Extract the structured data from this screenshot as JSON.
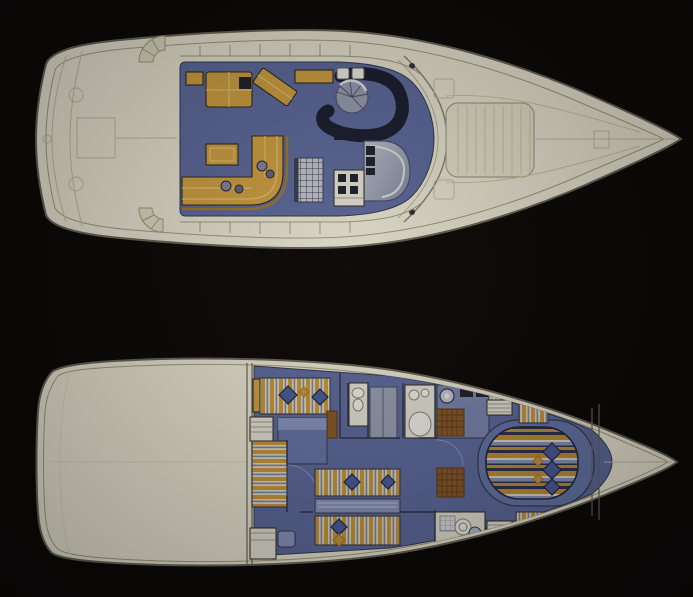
{
  "page": {
    "title": "Motor yacht general-arrangement drawing: two deck plans on black background",
    "upper_plan_label": "Main deck plan (aft cockpit, saloon, dinette, helm, foredeck sun pad)",
    "lower_plan_label": "Lower deck plan (aft cabin, twin cabin, heads, galley, owner island-berth cabin, forepeak)"
  },
  "palette": {
    "background": "#0b0908",
    "hull": "#eeebd9",
    "hullLine": "#6b675a",
    "sheerLine": "#a59f82",
    "deckFaint": "#c6c1a4",
    "carpet": "#5f6da2",
    "carpetEdge": "#353a52",
    "gold": "#d4a444",
    "goldLight": "#e7c878",
    "goldDark": "#a87c24",
    "outlineDark": "#2e2a1e",
    "navySeat": "#1a1f31",
    "steelGray": "#9aa2b6",
    "steelDark": "#4a5068",
    "panelCream": "#e9e7db",
    "instrDark": "#20242e",
    "checkLight": "#c6cad4",
    "checkDark": "#3a4054",
    "white": "#f2f2ea",
    "brown": "#8a5a2c",
    "brownDark": "#5a3a16",
    "slate": "#7e8ab0",
    "pillow": "#4a5f9e",
    "pillowDark": "#20283f",
    "stripeCream": "#e6dec4",
    "stripeGold": "#cc9c3c",
    "bedNavy": "#2e3452",
    "bedGold": "#c49238",
    "bedSlate": "#8c98c0",
    "blueSofa": "#6878ae",
    "blueSofaLight": "#8a98c4",
    "fixtureWhite": "#f4f4ee",
    "fixtureLine": "#8a877a",
    "wall": "#2f3342",
    "decorGray": "#8a86a0",
    "decorDark": "#6a6684"
  }
}
